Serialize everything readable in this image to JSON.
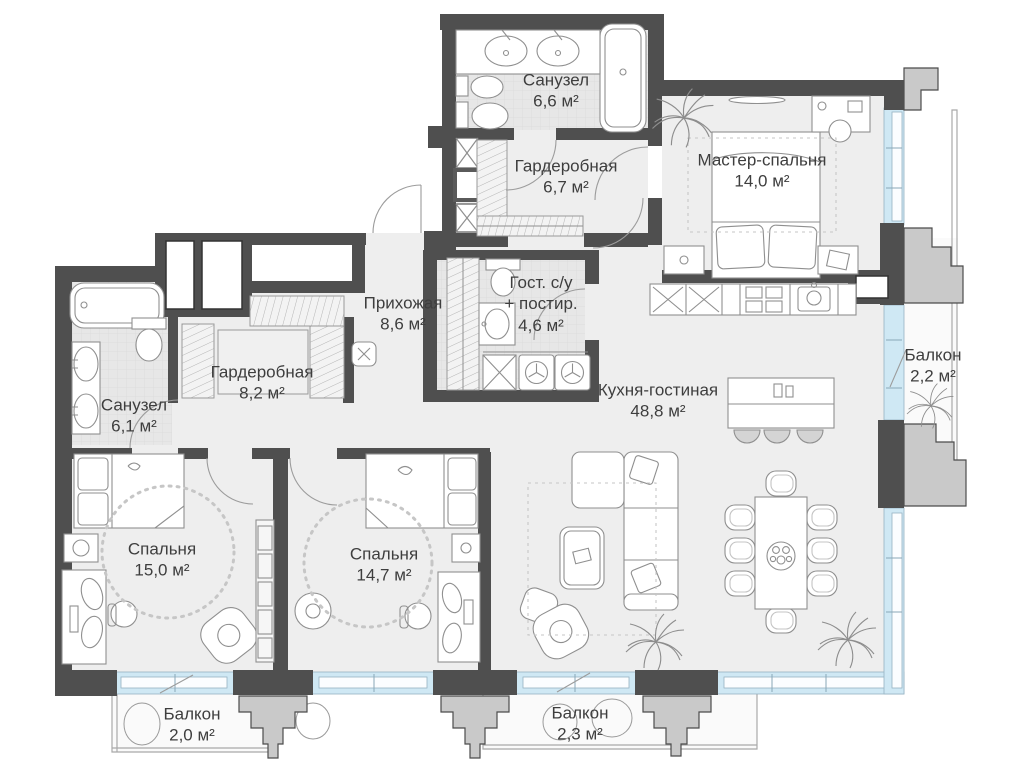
{
  "plan": {
    "type": "apartment-floor-plan",
    "units": "м²",
    "colors": {
      "wall": "#4f4f4f",
      "floor": "#eeeeee",
      "wet_floor": "#e8e8e8",
      "glazing": "#cfe8f4",
      "pillar": "#c9c9c9",
      "furniture_line": "#8f8f8f",
      "label_text": "#3e3e3e"
    },
    "rooms": [
      {
        "id": "sanuzel-top",
        "name": "Санузел",
        "area": "6,6 м²"
      },
      {
        "id": "garderobnaya-top",
        "name": "Гардеробная",
        "area": "6,7 м²"
      },
      {
        "id": "master-bedroom",
        "name": "Мастер-спальня",
        "area": "14,0 м²"
      },
      {
        "id": "prihozhaya",
        "name": "Прихожая",
        "area": "8,6 м²"
      },
      {
        "id": "guest-su",
        "name": "Гост. с/у",
        "name2": "+ постир.",
        "area": "4,6 м²"
      },
      {
        "id": "sanuzel-left",
        "name": "Санузел",
        "area": "6,1 м²"
      },
      {
        "id": "garderobnaya-left",
        "name": "Гардеробная",
        "area": "8,2 м²"
      },
      {
        "id": "kitchen-living",
        "name": "Кухня-гостиная",
        "area": "48,8 м²"
      },
      {
        "id": "balcony-right",
        "name": "Балкон",
        "area": "2,2 м²"
      },
      {
        "id": "bedroom-1",
        "name": "Спальня",
        "area": "15,0 м²"
      },
      {
        "id": "bedroom-2",
        "name": "Спальня",
        "area": "14,7 м²"
      },
      {
        "id": "balcony-bottom-left",
        "name": "Балкон",
        "area": "2,0 м²"
      },
      {
        "id": "balcony-bottom-center",
        "name": "Балкон",
        "area": "2,3 м²"
      }
    ]
  }
}
